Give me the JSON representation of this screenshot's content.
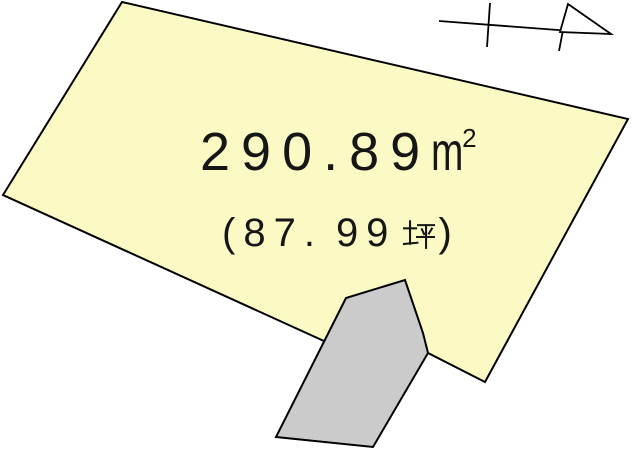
{
  "diagram": {
    "background": "#ffffff",
    "line_color": "#000000"
  },
  "land_plot": {
    "fill": "#fbfac5",
    "area_sqm_label": "290.89㎡",
    "area_sqm_value": "290.89",
    "area_sqm_unit": "m",
    "area_sqm_exponent": "2",
    "area_tsubo_label": "(87.99坪)",
    "area_tsubo_prefix": "(87.",
    "area_tsubo_digits": "99",
    "area_tsubo_unit": "坪",
    "area_tsubo_close": ")"
  },
  "adjacent_structure": {
    "fill": "#cbcbcb"
  }
}
